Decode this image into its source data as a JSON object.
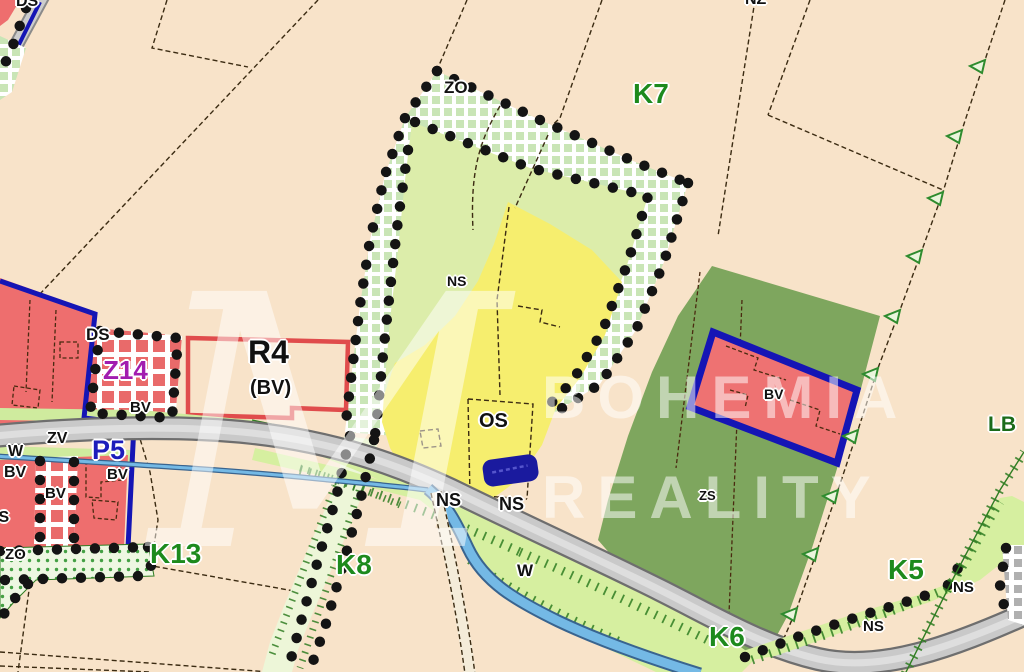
{
  "map": {
    "labels": {
      "ds_top": "DS",
      "nz": "NZ",
      "zo_top": "ZO",
      "k7": "K7",
      "ns_area": "NS",
      "ds_z14": "DS",
      "z14": "Z14",
      "bv_z14": "BV",
      "r4": "R4",
      "r4_sub": "(BV)",
      "zv": "ZV",
      "w_west": "W",
      "p5": "P5",
      "bv_w1": "BV",
      "bv_w2": "BV",
      "bv_w3": "BV",
      "os_edge": "OS",
      "zo_sw": "ZO",
      "k13": "K13",
      "k8": "K8",
      "os_main": "OS",
      "ns_road1": "NS",
      "ns_road2": "NS",
      "w_stream": "W",
      "k6": "K6",
      "zs": "ZS",
      "bv_east": "BV",
      "lb": "LB",
      "k5": "K5",
      "ns_se1": "NS",
      "ns_se2": "NS"
    },
    "watermark": {
      "monogram": "M",
      "line1": "BOHEMIA",
      "line2": "REALITY"
    },
    "colors": {
      "background": "#f8e3c9",
      "field_green": "#dcedaa",
      "field_yellow": "#f6ee6e",
      "garden_green": "#7ea65e",
      "built_red": "#ee6e6e",
      "boundary_blue": "#1515b5",
      "road_gray": "#c9c9c9",
      "water_blue": "#74b9e5",
      "label_green": "#1d8a1d",
      "z14_magenta": "#a21caf",
      "p5_blue": "#1d1dbb",
      "dot_black": "#141414",
      "r4_border_red": "#e04c4c"
    }
  }
}
